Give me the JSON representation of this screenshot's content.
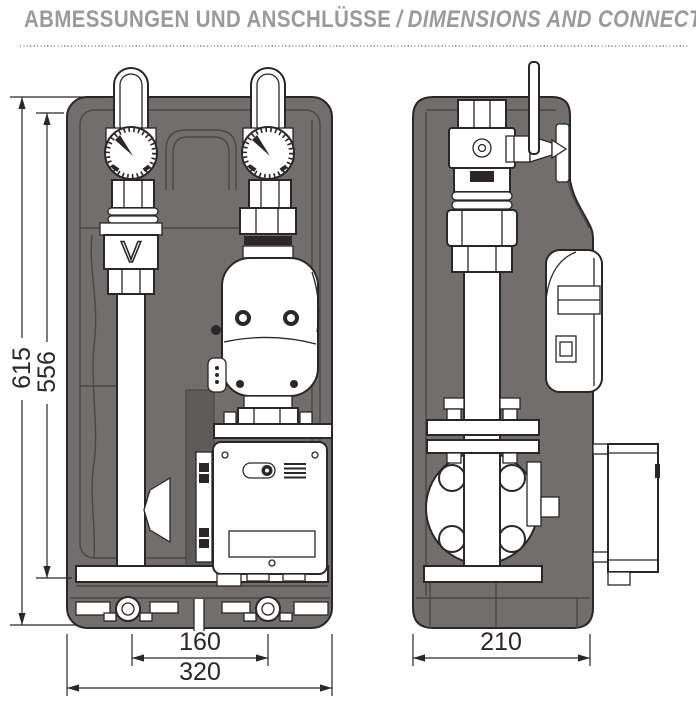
{
  "header": {
    "title_de": "ABMESSUNGEN UND ANSCHLÜSSE",
    "separator": "/",
    "title_en": "DIMENSIONS AND CONNECTIONS"
  },
  "front_view": {
    "dim_total_height": "615",
    "dim_inner_height": "556",
    "dim_port_spacing": "160",
    "dim_width": "320",
    "check_valve_mark": "V"
  },
  "side_view": {
    "dim_depth": "210"
  },
  "colors": {
    "insulation": "#716e6e",
    "insulation-dark": "#5e5b5b",
    "line": "#2b2627",
    "seam": "#4a4747",
    "title-text": "#9a9a9a",
    "dots": "#a8a8a8"
  }
}
